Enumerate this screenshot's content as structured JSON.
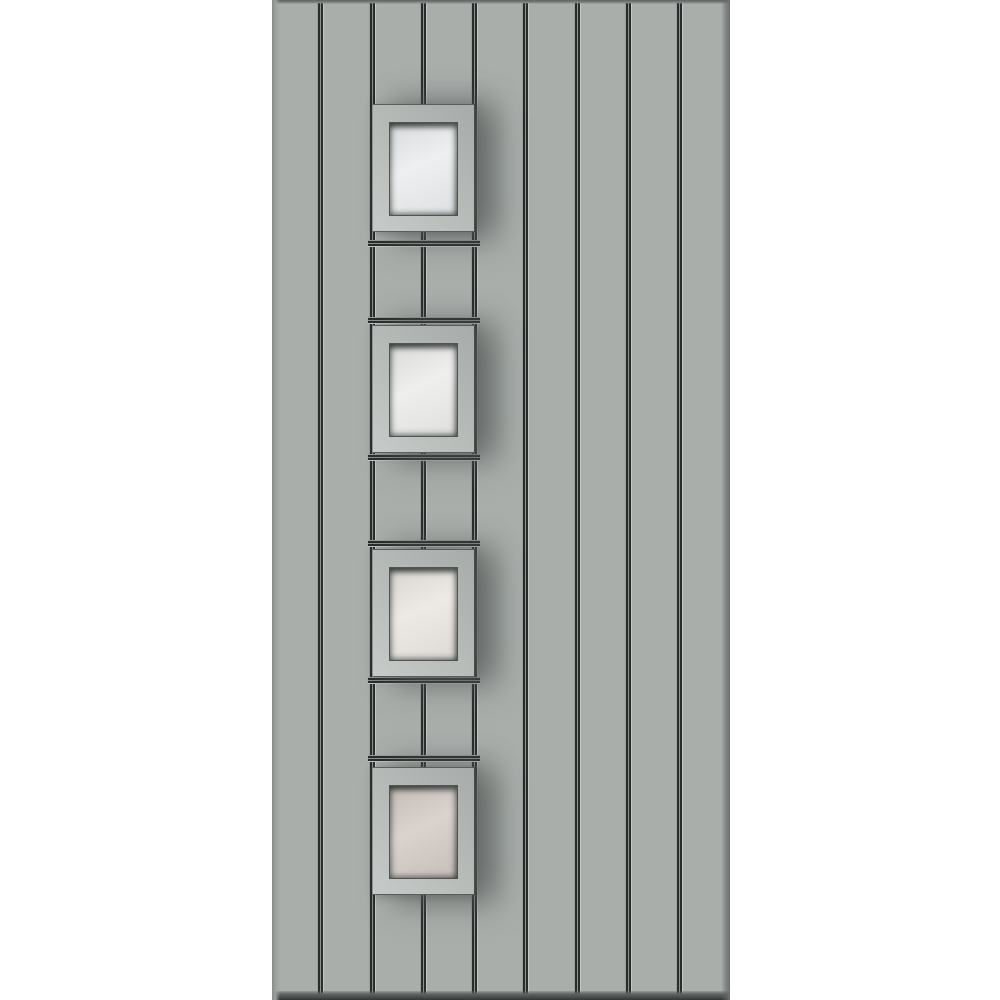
{
  "scene": {
    "description": "Light grey contemporary front door with vertical tongue-and-groove planks and four square glazed lites stacked down the left-centre column, shown on a white background",
    "background_color": "#ffffff"
  },
  "door": {
    "base_color": "#a9aeab",
    "plank_count": 9,
    "vertical_groove_count": 8,
    "groove_dark_color": "#282d2b",
    "groove_mid_color": "#8d928f",
    "groove_highlight_color": "#c3c8c5",
    "edge_shadow_color": "#5d6160"
  },
  "lites": {
    "count": 4,
    "frame_color": "#b7bcb9",
    "recess_color": "#3a3e3c",
    "items": [
      {
        "name": "lite-1",
        "glass_color": "#e9ebec",
        "glass_tint": "cool white"
      },
      {
        "name": "lite-2",
        "glass_color": "#eaebe9",
        "glass_tint": "neutral white"
      },
      {
        "name": "lite-3",
        "glass_color": "#e8e4de",
        "glass_tint": "warm off-white"
      },
      {
        "name": "lite-4",
        "glass_color": "#cfc6c0",
        "glass_tint": "warm beige"
      }
    ]
  }
}
